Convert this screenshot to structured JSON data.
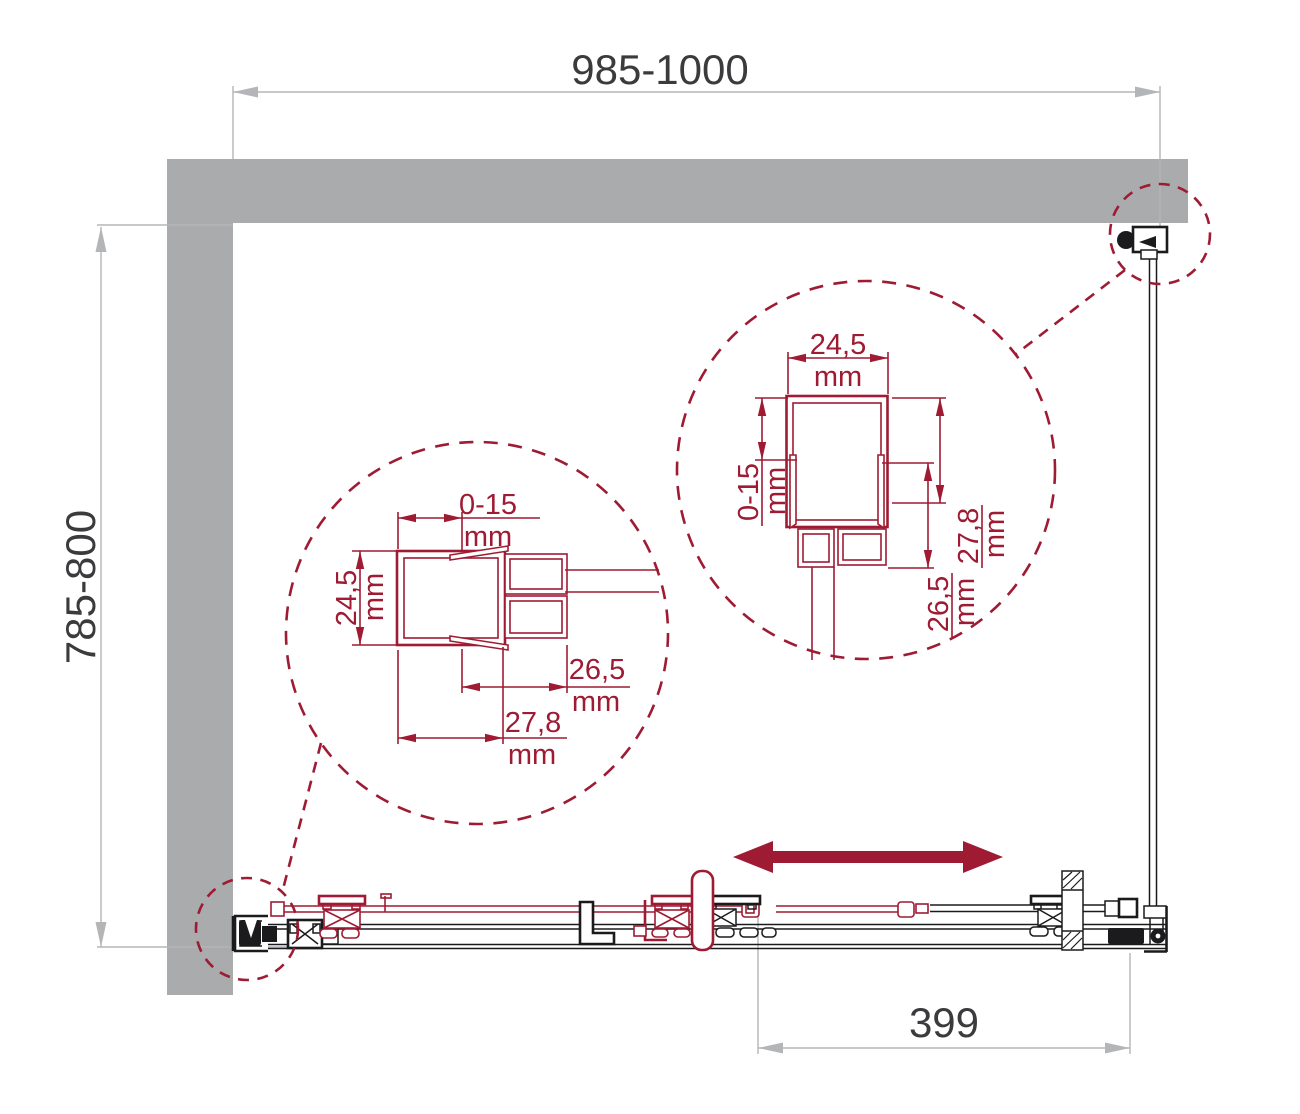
{
  "colors": {
    "maroon_accent": "#9E1B33",
    "wall_gray": "#AAABAD",
    "dimension_gray": "#B4B5B7",
    "dimension_text": "#3B3B3D",
    "drawing_black": "#1B1B1D"
  },
  "dimensions": {
    "overall_width": "985-1000",
    "overall_depth": "785-800",
    "door_opening": "399"
  },
  "detail_left": {
    "adjust_range": "0-15",
    "adjust_range_unit": "mm",
    "profile_width": "24,5",
    "profile_width_unit": "mm",
    "dim_a": "26,5",
    "dim_a_unit": "mm",
    "dim_b": "27,8",
    "dim_b_unit": "mm"
  },
  "detail_right": {
    "profile_width": "24,5",
    "profile_width_unit": "mm",
    "adjust_range": "0-15",
    "adjust_range_unit": "mm",
    "dim_b": "27,8",
    "dim_b_unit": "mm",
    "dim_a": "26,5",
    "dim_a_unit": "mm"
  }
}
